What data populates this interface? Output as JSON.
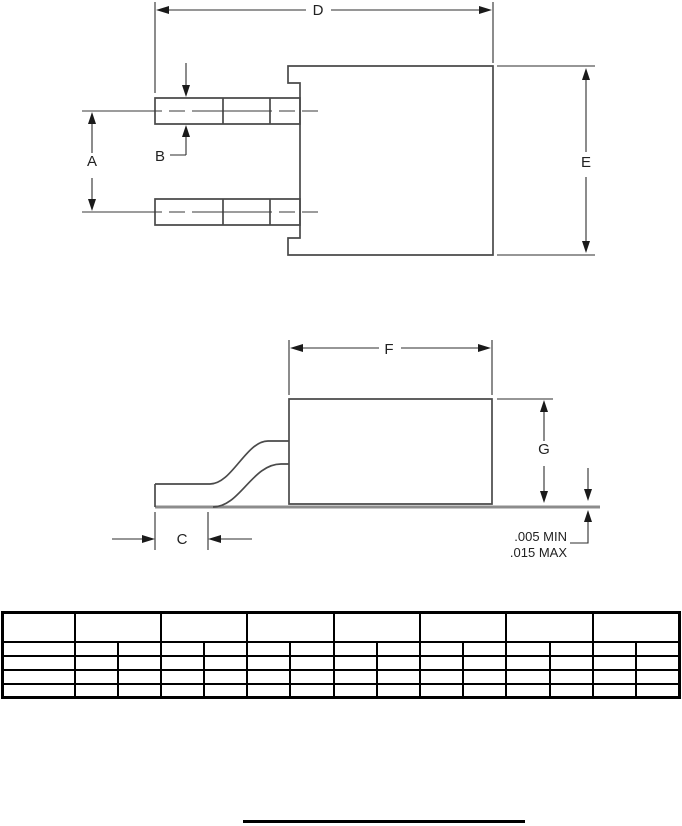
{
  "drawing": {
    "dims": {
      "a": "A",
      "b": "B",
      "c": "C",
      "d": "D",
      "e": "E",
      "f": "F",
      "g": "G"
    },
    "standoff": {
      "min_label": ".005 MIN",
      "max_label": ".015 MAX"
    }
  },
  "dim_table": {
    "header_row": [
      "",
      "",
      "",
      "",
      "",
      "",
      "",
      ""
    ],
    "rows": [
      [
        "",
        "",
        "",
        "",
        "",
        "",
        "",
        "",
        "",
        "",
        "",
        "",
        "",
        "",
        ""
      ],
      [
        "",
        "",
        "",
        "",
        "",
        "",
        "",
        "",
        "",
        "",
        "",
        "",
        "",
        "",
        ""
      ],
      [
        "",
        "",
        "",
        "",
        "",
        "",
        "",
        "",
        "",
        "",
        "",
        "",
        "",
        "",
        ""
      ],
      [
        "",
        "",
        "",
        "",
        "",
        "",
        "",
        "",
        "",
        "",
        "",
        "",
        "",
        "",
        ""
      ]
    ]
  }
}
